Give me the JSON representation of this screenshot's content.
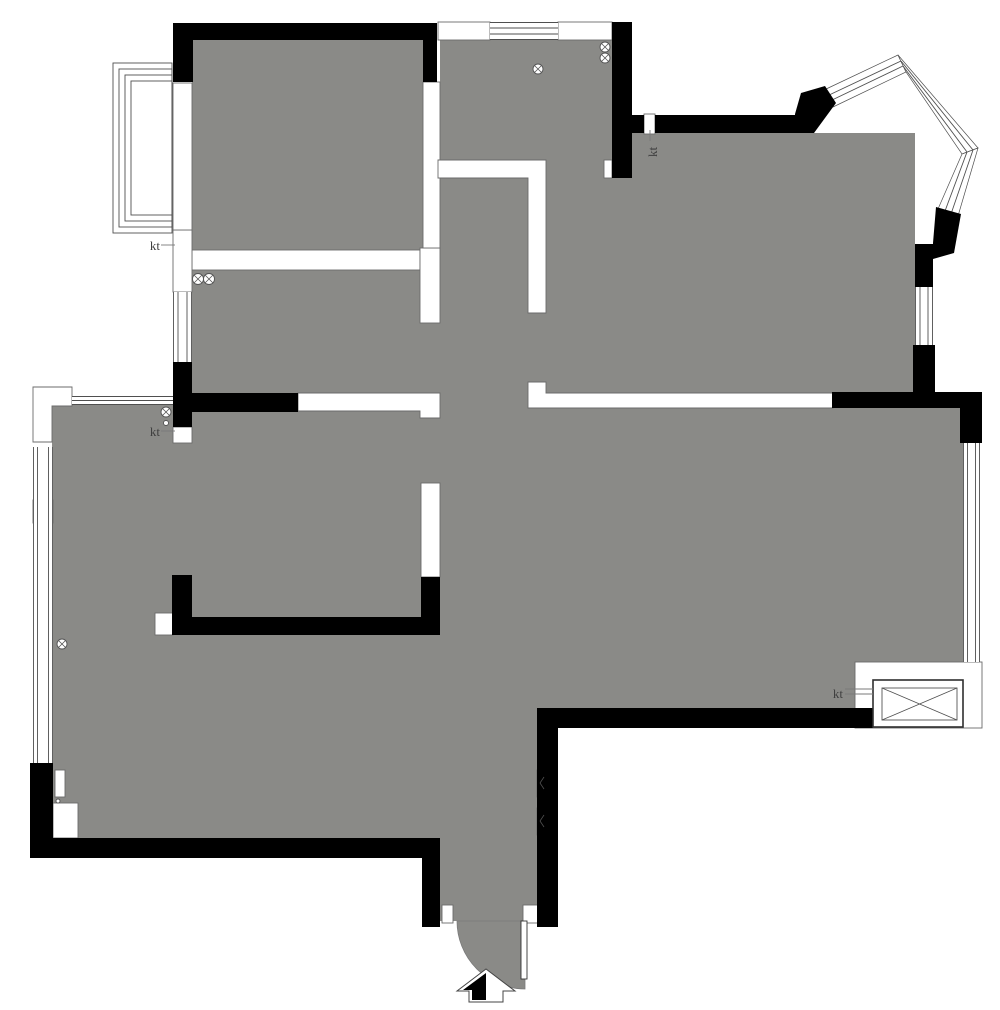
{
  "meta": {
    "title": "apartment-floor-plan",
    "canvas_width": 1000,
    "canvas_height": 1010
  },
  "colors": {
    "floor": "#8a8a87",
    "wall": "#000000",
    "light_wall_fill": "#ffffff",
    "light_wall_outline": "#6b6b6b",
    "window_line": "#4f4f4f",
    "leader": "#7a7a7a",
    "label": "#3f3f3f",
    "background": "#ffffff"
  },
  "plan": {
    "floor_rects": [
      [
        52,
        405,
        388,
        433
      ],
      [
        440,
        408,
        523,
        300
      ],
      [
        440,
        392,
        97,
        529
      ],
      [
        192,
        40,
        231,
        210
      ],
      [
        192,
        250,
        231,
        144
      ],
      [
        440,
        40,
        172,
        120
      ],
      [
        438,
        160,
        108,
        252
      ],
      [
        420,
        248,
        20,
        164
      ],
      [
        632,
        133,
        283,
        261
      ],
      [
        546,
        160,
        86,
        234
      ]
    ],
    "door_arc_path": "M525,921 L457,921 A68,68 0 0 0 525,989 Z",
    "light_wall_rects": [
      [
        192,
        250,
        228,
        20
      ],
      [
        420,
        248,
        20,
        75
      ],
      [
        423,
        82,
        17,
        166
      ],
      [
        421,
        483,
        19,
        94
      ],
      [
        438,
        22,
        52,
        18
      ],
      [
        558,
        22,
        54,
        18
      ],
      [
        604,
        160,
        8,
        18
      ],
      [
        644,
        114,
        11,
        20
      ],
      [
        173,
        427,
        19,
        16
      ],
      [
        173,
        230,
        19,
        62
      ],
      [
        173,
        83,
        19,
        147
      ],
      [
        155,
        613,
        18,
        22
      ],
      [
        33,
        500,
        20,
        23
      ],
      [
        53,
        803,
        25,
        35
      ],
      [
        55,
        770,
        10,
        27
      ],
      [
        442,
        905,
        11,
        18
      ],
      [
        523,
        905,
        15,
        18
      ],
      [
        537,
        770,
        8,
        27
      ],
      [
        537,
        808,
        8,
        27
      ],
      [
        855,
        662,
        127,
        66
      ]
    ],
    "light_wall_polys": [
      [
        [
          438,
          160
        ],
        [
          546,
          160
        ],
        [
          546,
          313
        ],
        [
          528,
          313
        ],
        [
          528,
          178
        ],
        [
          438,
          178
        ]
      ],
      [
        [
          528,
          382
        ],
        [
          546,
          382
        ],
        [
          546,
          393
        ],
        [
          833,
          393
        ],
        [
          833,
          408
        ],
        [
          528,
          408
        ]
      ],
      [
        [
          298,
          393
        ],
        [
          440,
          393
        ],
        [
          440,
          418
        ],
        [
          420,
          418
        ],
        [
          420,
          411
        ],
        [
          298,
          411
        ]
      ],
      [
        [
          33,
          387
        ],
        [
          72,
          387
        ],
        [
          72,
          406
        ],
        [
          52,
          406
        ],
        [
          52,
          442
        ],
        [
          33,
          442
        ]
      ]
    ],
    "window_fill_rects": [
      [
        173,
        292,
        19,
        70
      ],
      [
        72,
        396,
        101,
        9
      ],
      [
        33,
        447,
        20,
        316
      ],
      [
        490,
        22,
        68,
        18
      ],
      [
        915,
        287,
        18,
        58
      ],
      [
        963,
        443,
        17,
        219
      ]
    ],
    "window_band_polys": [
      [
        [
          824,
          90
        ],
        [
          898,
          55
        ],
        [
          906,
          72
        ],
        [
          833,
          107
        ]
      ],
      [
        [
          898,
          55
        ],
        [
          978,
          148
        ],
        [
          962,
          154
        ],
        [
          906,
          72
        ]
      ],
      [
        [
          978,
          148
        ],
        [
          958,
          216
        ],
        [
          938,
          209
        ],
        [
          962,
          154
        ]
      ]
    ],
    "balcony_frame_rects": [
      [
        113,
        63,
        59,
        170
      ],
      [
        119,
        69,
        53,
        158
      ],
      [
        125,
        75,
        47,
        146
      ],
      [
        131,
        81,
        41,
        134
      ]
    ],
    "window_lines": [
      [
        173.5,
        292,
        173.5,
        362
      ],
      [
        178,
        292,
        178,
        362
      ],
      [
        187,
        292,
        187,
        362
      ],
      [
        191.5,
        292,
        191.5,
        362
      ],
      [
        72,
        396.5,
        173,
        396.5
      ],
      [
        72,
        400.5,
        173,
        400.5
      ],
      [
        72,
        404.5,
        173,
        404.5
      ],
      [
        33.5,
        447,
        33.5,
        763
      ],
      [
        37.5,
        447,
        37.5,
        763
      ],
      [
        48.5,
        447,
        48.5,
        763
      ],
      [
        52.5,
        447,
        52.5,
        763
      ],
      [
        490,
        22.5,
        558,
        22.5
      ],
      [
        490,
        28,
        558,
        28
      ],
      [
        490,
        34,
        558,
        34
      ],
      [
        490,
        39.5,
        558,
        39.5
      ],
      [
        915.5,
        287,
        915.5,
        345
      ],
      [
        920,
        287,
        920,
        345
      ],
      [
        928,
        287,
        928,
        345
      ],
      [
        932.5,
        287,
        932.5,
        345
      ],
      [
        963.5,
        443,
        963.5,
        662
      ],
      [
        967.5,
        443,
        967.5,
        662
      ],
      [
        975.5,
        443,
        975.5,
        662
      ],
      [
        979.5,
        443,
        979.5,
        662
      ],
      [
        827,
        96,
        901,
        61
      ],
      [
        830,
        101,
        903,
        66
      ],
      [
        901,
        61,
        973,
        150
      ],
      [
        903,
        66,
        967,
        152
      ],
      [
        973,
        150,
        951,
        214
      ],
      [
        967,
        152,
        945,
        211
      ]
    ],
    "wall_rects": [
      [
        173,
        23,
        264,
        17
      ],
      [
        173,
        40,
        20,
        42
      ],
      [
        423,
        40,
        14,
        42
      ],
      [
        612,
        22,
        20,
        156
      ],
      [
        632,
        115,
        12,
        18
      ],
      [
        655,
        115,
        145,
        18
      ],
      [
        915,
        244,
        18,
        43
      ],
      [
        913,
        345,
        22,
        47
      ],
      [
        832,
        392,
        150,
        16
      ],
      [
        960,
        408,
        22,
        35
      ],
      [
        537,
        708,
        336,
        20
      ],
      [
        537,
        708,
        21,
        219
      ],
      [
        422,
        858,
        18,
        69
      ],
      [
        30,
        763,
        23,
        95
      ],
      [
        30,
        838,
        410,
        20
      ],
      [
        421,
        577,
        19,
        58
      ]
    ],
    "wall_polys": [
      [
        [
          795,
          133
        ],
        [
          795,
          114
        ],
        [
          801,
          93
        ],
        [
          825,
          86
        ],
        [
          836,
          103
        ],
        [
          814,
          133
        ]
      ],
      [
        [
          936,
          207
        ],
        [
          961,
          214
        ],
        [
          954,
          253
        ],
        [
          933,
          259
        ],
        [
          933,
          243
        ]
      ],
      [
        [
          173,
          362
        ],
        [
          192,
          362
        ],
        [
          192,
          393
        ],
        [
          298,
          393
        ],
        [
          298,
          412
        ],
        [
          192,
          412
        ],
        [
          192,
          427
        ],
        [
          173,
          427
        ]
      ],
      [
        [
          172,
          575
        ],
        [
          192,
          575
        ],
        [
          192,
          617
        ],
        [
          440,
          617
        ],
        [
          440,
          635
        ],
        [
          172,
          635
        ]
      ]
    ],
    "fixture_rects": [
      {
        "n": "ac-unit-outer-box",
        "r": [
          873,
          680,
          90,
          47
        ],
        "f": "#ffffff",
        "s": "#2f2f2f",
        "w": 1.6
      },
      {
        "n": "ac-unit-inner-box",
        "r": [
          882,
          688,
          75,
          32
        ],
        "f": "#ffffff",
        "s": "#555555",
        "w": 0.9
      },
      {
        "n": "door-leaf",
        "r": [
          521,
          921,
          6,
          58
        ],
        "f": "#ffffff",
        "s": "#333333",
        "w": 0.9
      }
    ],
    "fixture_lines": [
      [
        882,
        688,
        957,
        720
      ],
      [
        882,
        720,
        957,
        688
      ],
      [
        544,
        777,
        540,
        783
      ],
      [
        540,
        783,
        544,
        789
      ],
      [
        544,
        815,
        540,
        821
      ],
      [
        540,
        821,
        544,
        827
      ]
    ],
    "leader_lines": [
      [
        161,
        245,
        175,
        245
      ],
      [
        161,
        431,
        175,
        431
      ],
      [
        650,
        130,
        650,
        141
      ],
      [
        845,
        689,
        873,
        689
      ],
      [
        845,
        694,
        873,
        694
      ]
    ],
    "drain_circles": [
      [
        198,
        279,
        5.5
      ],
      [
        209,
        279,
        5.5
      ],
      [
        538,
        69,
        5
      ],
      [
        605,
        47,
        5
      ],
      [
        605,
        58,
        5
      ],
      [
        166,
        412,
        5
      ],
      [
        62,
        644,
        5
      ]
    ],
    "small_circles": [
      [
        166,
        423,
        2.5
      ],
      [
        58,
        801,
        2
      ]
    ],
    "labels": [
      {
        "text": "kt",
        "x": 160,
        "y": 250,
        "anchor": "end",
        "rotate": 0
      },
      {
        "text": "kt",
        "x": 160,
        "y": 436,
        "anchor": "end",
        "rotate": 0
      },
      {
        "text": "kt",
        "x": 657,
        "y": 157,
        "anchor": "start",
        "rotate": -90
      },
      {
        "text": "kt",
        "x": 843,
        "y": 698,
        "anchor": "end",
        "rotate": 0
      }
    ],
    "north_arrow": {
      "outline": [
        [
          486,
          969
        ],
        [
          457,
          991
        ],
        [
          469,
          991
        ],
        [
          469,
          1002
        ],
        [
          503,
          1002
        ],
        [
          503,
          991
        ],
        [
          515,
          991
        ]
      ],
      "filled": [
        [
          486,
          973
        ],
        [
          463,
          990
        ],
        [
          472,
          990
        ],
        [
          472,
          1000
        ],
        [
          486,
          1000
        ]
      ]
    }
  }
}
